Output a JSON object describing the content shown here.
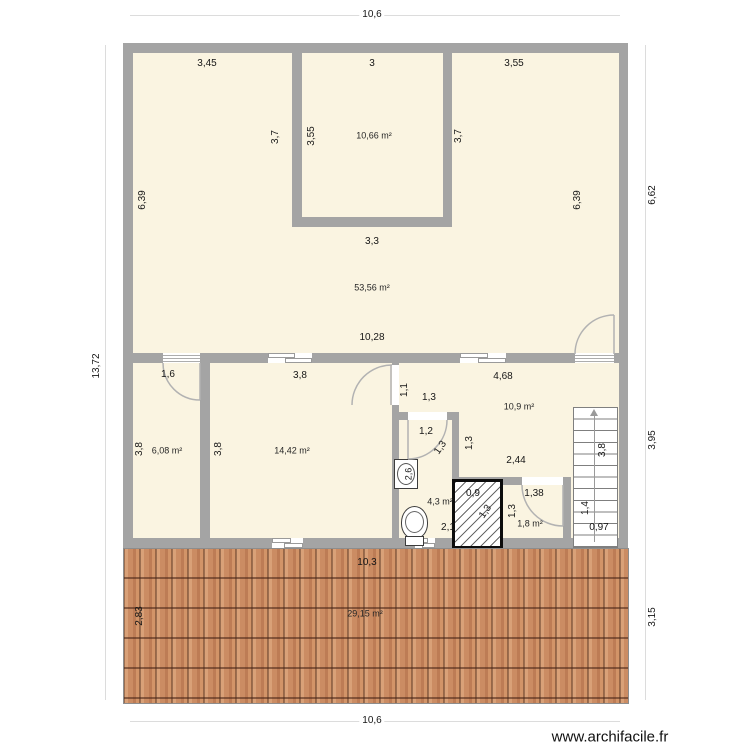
{
  "watermark": "www.archifacile.fr",
  "colors": {
    "room_fill": "#faf4e1",
    "wall": "#a4a4a4",
    "roof_tile": "#c8875f"
  },
  "outer_dims": {
    "top_width": "10,6",
    "bottom_width": "10,6",
    "left_height": "13,72",
    "right_upper": "6,62",
    "right_middle": "3,95",
    "right_lower": "3,15"
  },
  "upper_floor": {
    "seg_left_width": "3,45",
    "seg_center_width": "3",
    "seg_right_width": "3,55",
    "left_height": "6,39",
    "right_height": "6,39",
    "inner_room": {
      "area": "10,66 m²",
      "height": "3,55",
      "wall_left": "3,7",
      "wall_right": "3,7"
    },
    "living": {
      "area": "53,56 m²",
      "below_inner_width": "3,3",
      "width": "10,28"
    }
  },
  "lower_floor": {
    "room1": {
      "area": "6,08 m²",
      "door_width": "1,6",
      "height": "3,8"
    },
    "room2": {
      "area": "14,42 m²",
      "width": "3,8",
      "height": "3,8"
    },
    "room3": {
      "area": "10,9 m²",
      "width": "4,68",
      "step_height": "1,1",
      "step_width": "1,3",
      "inner_height": "1,3",
      "inner_width": "2,44"
    },
    "bathroom": {
      "area": "4,3 m²",
      "door_width": "1,2",
      "door_side": "1,3",
      "sink_side": "2,6",
      "width": "2,1"
    },
    "shower": {
      "width": "0,9",
      "height": "1,3"
    },
    "wc": {
      "area": "1,8 m²",
      "door_width": "1,38",
      "height": "1,3"
    },
    "stairs": {
      "height": "3,8",
      "run": "1,4",
      "width": "0,97"
    }
  },
  "roof": {
    "width": "10,3",
    "height": "2,83",
    "area": "29,15 m²"
  }
}
